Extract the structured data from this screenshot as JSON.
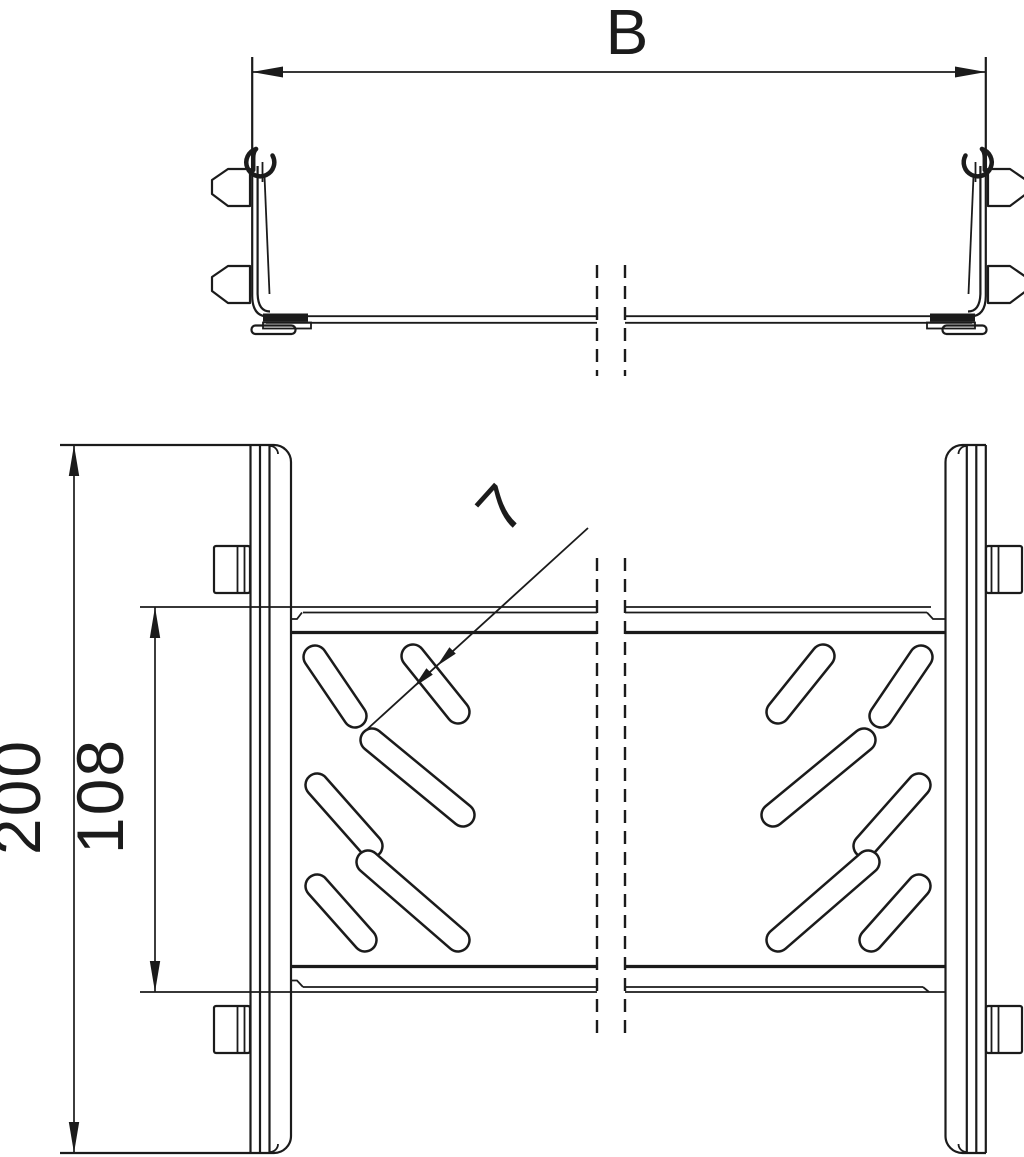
{
  "page": {
    "background": "#ffffff",
    "line_color": "#1b1b1b"
  },
  "dimensions": {
    "width_label": "B",
    "overall_length": "200",
    "inner_length": "108",
    "slot_width": "7"
  }
}
